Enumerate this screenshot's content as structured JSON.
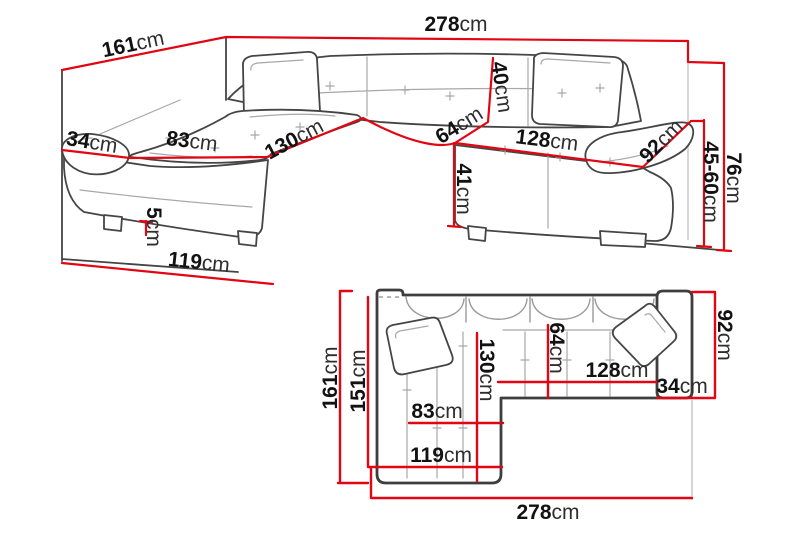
{
  "diagram_title": "Corner sofa dimensions diagram",
  "colors": {
    "dimension_line": "#e20613",
    "outline": "#454545",
    "sketch": "#a8a8a8",
    "text": "#141414",
    "background": "#ffffff"
  },
  "perspective_view": {
    "labels": {
      "width_total": {
        "value": "278",
        "unit": "cm"
      },
      "depth_total": {
        "value": "161",
        "unit": "cm"
      },
      "backrest_height": {
        "value": "40",
        "unit": "cm"
      },
      "seat_depth": {
        "value": "64",
        "unit": "cm"
      },
      "seat_width": {
        "value": "128",
        "unit": "cm"
      },
      "armrest_length": {
        "value": "92",
        "unit": "cm"
      },
      "height_total": {
        "value": "76",
        "unit": "cm"
      },
      "armrest_height": {
        "value": "45-60",
        "unit": "cm"
      },
      "seat_height": {
        "value": "41",
        "unit": "cm"
      },
      "chaise_length": {
        "value": "130",
        "unit": "cm"
      },
      "chaise_seat_width": {
        "value": "83",
        "unit": "cm"
      },
      "armrest_width": {
        "value": "34",
        "unit": "cm"
      },
      "leg_height": {
        "value": "5",
        "unit": "cm"
      },
      "chaise_front_width": {
        "value": "119",
        "unit": "cm"
      }
    }
  },
  "plan_view": {
    "labels": {
      "depth_total": {
        "value": "161",
        "unit": "cm"
      },
      "depth_inner": {
        "value": "151",
        "unit": "cm"
      },
      "chaise_length": {
        "value": "130",
        "unit": "cm"
      },
      "seat_depth": {
        "value": "64",
        "unit": "cm"
      },
      "seat_width": {
        "value": "128",
        "unit": "cm"
      },
      "armrest_width": {
        "value": "34",
        "unit": "cm"
      },
      "armrest_depth": {
        "value": "92",
        "unit": "cm"
      },
      "chaise_seat_width": {
        "value": "83",
        "unit": "cm"
      },
      "chaise_front_width": {
        "value": "119",
        "unit": "cm"
      },
      "width_total": {
        "value": "278",
        "unit": "cm"
      }
    }
  }
}
